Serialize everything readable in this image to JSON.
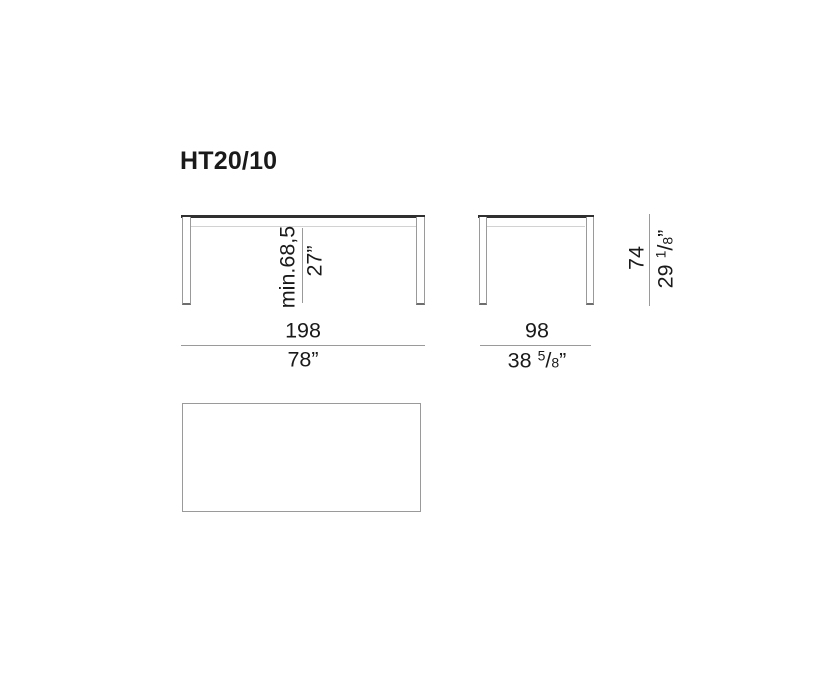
{
  "title": "HT20/10",
  "colors": {
    "background": "#ffffff",
    "text": "#1a1a1a",
    "line_dark": "#303030",
    "line_gray": "#9a9a9a",
    "line_light": "#d2d2d2"
  },
  "views": {
    "front": {
      "clearance": {
        "metric": "min.68,5",
        "imperial": "27”"
      },
      "width": {
        "metric": "198",
        "imperial": "78”"
      }
    },
    "side": {
      "width": {
        "metric": "98",
        "imperial": {
          "whole": "38 ",
          "numerator": "5",
          "sep": "/",
          "denominator": "8",
          "suffix": "”"
        }
      }
    },
    "height": {
      "metric": "74",
      "imperial": {
        "whole": "29 ",
        "numerator": "1",
        "sep": "/",
        "denominator": "8",
        "suffix": "”"
      }
    }
  }
}
